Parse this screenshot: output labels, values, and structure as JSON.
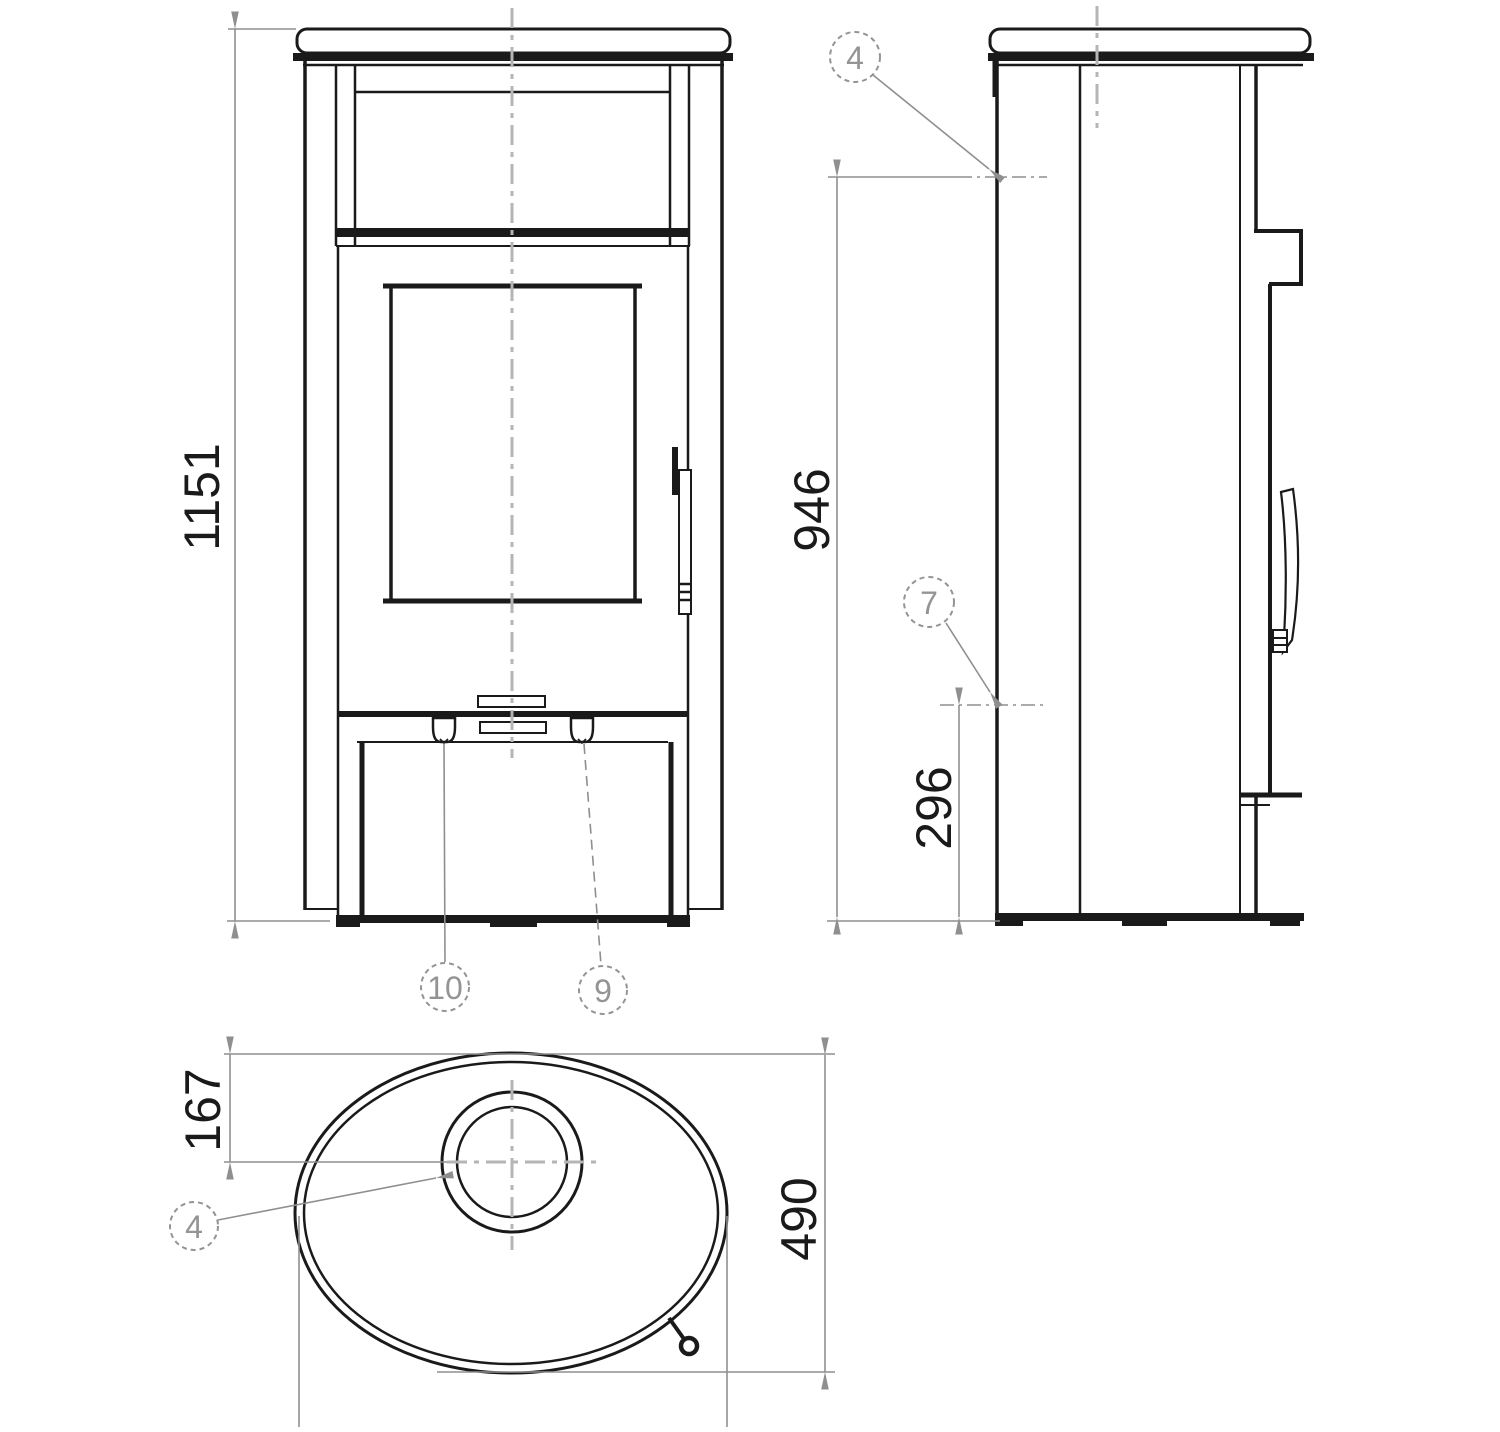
{
  "colors": {
    "line": "#1a1a1a",
    "dim_line": "#8f8f8f",
    "dim_text": "#1a1a1a",
    "callout": "#949494",
    "centerline": "#b5b5b5",
    "background": "#ffffff"
  },
  "views": {
    "front": {
      "overall_height_dim": "1151",
      "callouts": [
        {
          "id": "10"
        },
        {
          "id": "9"
        }
      ]
    },
    "side": {
      "flue_height_dim": "946",
      "rear_outlet_height_dim": "296",
      "callouts": [
        {
          "id": "4"
        },
        {
          "id": "7"
        }
      ]
    },
    "top": {
      "flue_offset_dim": "167",
      "depth_dim": "490",
      "callouts": [
        {
          "id": "4"
        }
      ]
    }
  }
}
